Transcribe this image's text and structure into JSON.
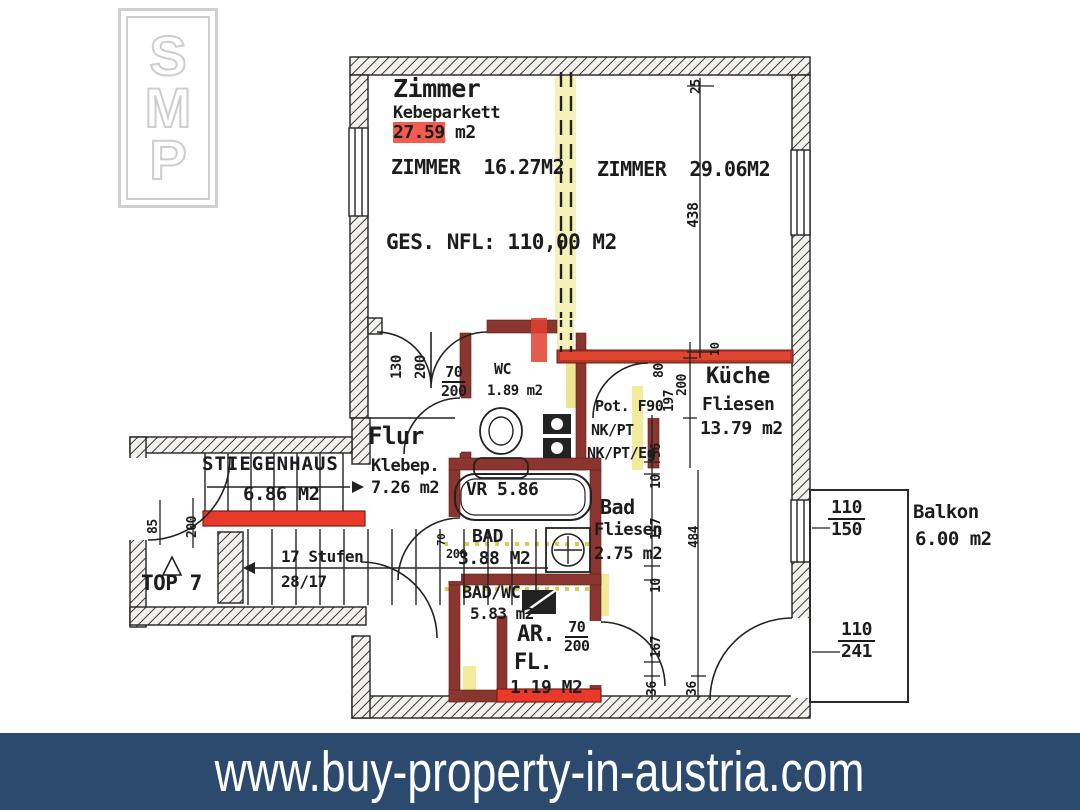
{
  "logo": {
    "letters": [
      "S",
      "M",
      "P"
    ]
  },
  "banner": {
    "url": "www.buy-property-in-austria.com",
    "bg": "#2b4a6e"
  },
  "plan": {
    "total": "GES. NFL: 110,00 M2",
    "rooms": {
      "zimmer": {
        "name": "Zimmer",
        "floor": "Kebeparkett",
        "area_value": "27.59",
        "area_unit": "m2"
      },
      "zimmer2": "ZIMMER  16.27M2",
      "zimmer3": "ZIMMER  29.06M2",
      "kueche": {
        "name": "Küche",
        "floor": "Fliesen",
        "area": "13.79 m2"
      },
      "flur": {
        "name": "Flur",
        "floor": "Klebep.",
        "area": "7.26 m2"
      },
      "stiegenhaus": {
        "name": "STIEGENHAUS",
        "area": "6.86 M2"
      },
      "top": "TOP 7",
      "wc": {
        "name": "WC",
        "area": "1.89 m2"
      },
      "vr": "VR 5.86",
      "bad": {
        "name": "Bad",
        "floor": "Fliesen",
        "area": "2.75 m2"
      },
      "bad2": {
        "name": "BAD",
        "area": "3.88 M2"
      },
      "badwc": {
        "name": "BAD/WC",
        "area": "5.83 m2"
      },
      "ar": {
        "line1": "AR.",
        "line2": "FL.",
        "area": "1.19 M2"
      },
      "balkon": {
        "name": "Balkon",
        "area": "6.00 m2"
      }
    },
    "stairs": {
      "steps": "17 Stufen",
      "ratio": "28/17"
    },
    "notes": {
      "pot": "Pot. F90",
      "nk": "NK/PT",
      "nkeg": "NK/PT/Eg"
    },
    "dims": {
      "d25": "25",
      "d438": "438",
      "dd130": "130",
      "dd200": "200",
      "wc70": "70",
      "wc200": "200",
      "k80": "80",
      "k197": "197",
      "k200": "200",
      "k10": "10",
      "c56": "56",
      "c10a": "10",
      "c157": "157",
      "c10b": "10",
      "c167": "167",
      "c36a": "36",
      "c484": "484",
      "c36b": "36",
      "s85": "85",
      "s200": "200",
      "w110a": "110",
      "w150": "150",
      "w110b": "110",
      "w241": "241",
      "ar70": "70",
      "ar200": "200",
      "bd70": "70",
      "bd200": "200"
    },
    "colors": {
      "marker_red": "#e8392b",
      "wall_red": "#8a3530",
      "marker_yellow": "#efe98f",
      "banner_navy": "#2b4a6e"
    }
  }
}
